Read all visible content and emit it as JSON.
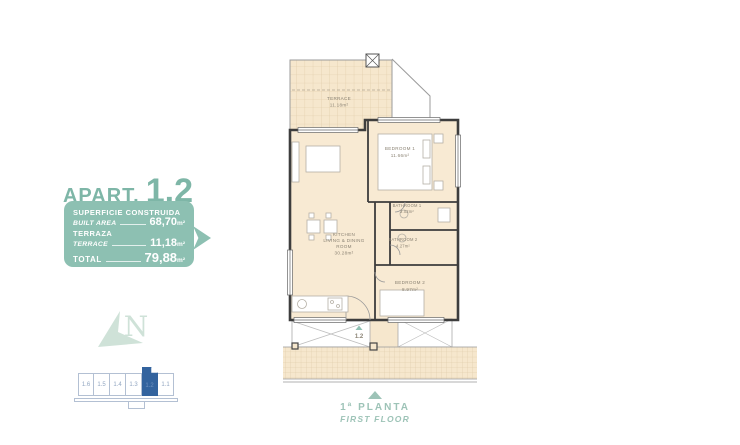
{
  "apartment": {
    "label_prefix": "APART.",
    "number": "1.2"
  },
  "area_table": {
    "row1_es": "SUPERFICIE CONSTRUIDA",
    "row1_en": "BUILT AREA",
    "row1_value": "68,70",
    "row1_unit": "m²",
    "row2_es": "TERRAZA",
    "row2_en": "TERRACE",
    "row2_value": "11,18",
    "row2_unit": "m²",
    "row3_label": "TOTAL",
    "row3_value": "79,88",
    "row3_unit": "m²"
  },
  "floor_plan": {
    "terrace": {
      "name": "TERRACE",
      "area": "11.18m²"
    },
    "bedroom1": {
      "name": "BEDROOM 1",
      "area": "11.66m²"
    },
    "living": {
      "line1": "KITCHEN",
      "line2": "LIVING & DINING",
      "line3": "ROOM",
      "area": "30.28m²"
    },
    "bathroom1": {
      "name": "BATHROOM 1",
      "area": "3.02m²"
    },
    "bathroom2": {
      "name": "BATHROOM 2",
      "area": "4.27m²"
    },
    "bedroom2": {
      "name": "BEDROOM 2",
      "area": "8.97m²"
    },
    "entrance_label": "1.2"
  },
  "building_strip": {
    "units": [
      "1.6",
      "1.5",
      "1.4",
      "1.3",
      "1.2",
      "1.1"
    ],
    "highlighted": "1.2"
  },
  "floor_indicator": {
    "es": "1ª PLANTA",
    "en": "FIRST FLOOR"
  },
  "compass": {
    "letter": "N"
  },
  "colors": {
    "brand_teal": "#8dc0b2",
    "title_teal": "#7eb6a7",
    "footer_teal": "#9dc3b7",
    "highlight_blue": "#33639e",
    "strip_outline": "#b3c0d3",
    "plan_floor": "#f6e7cd",
    "wall": "#3d3d3d"
  }
}
